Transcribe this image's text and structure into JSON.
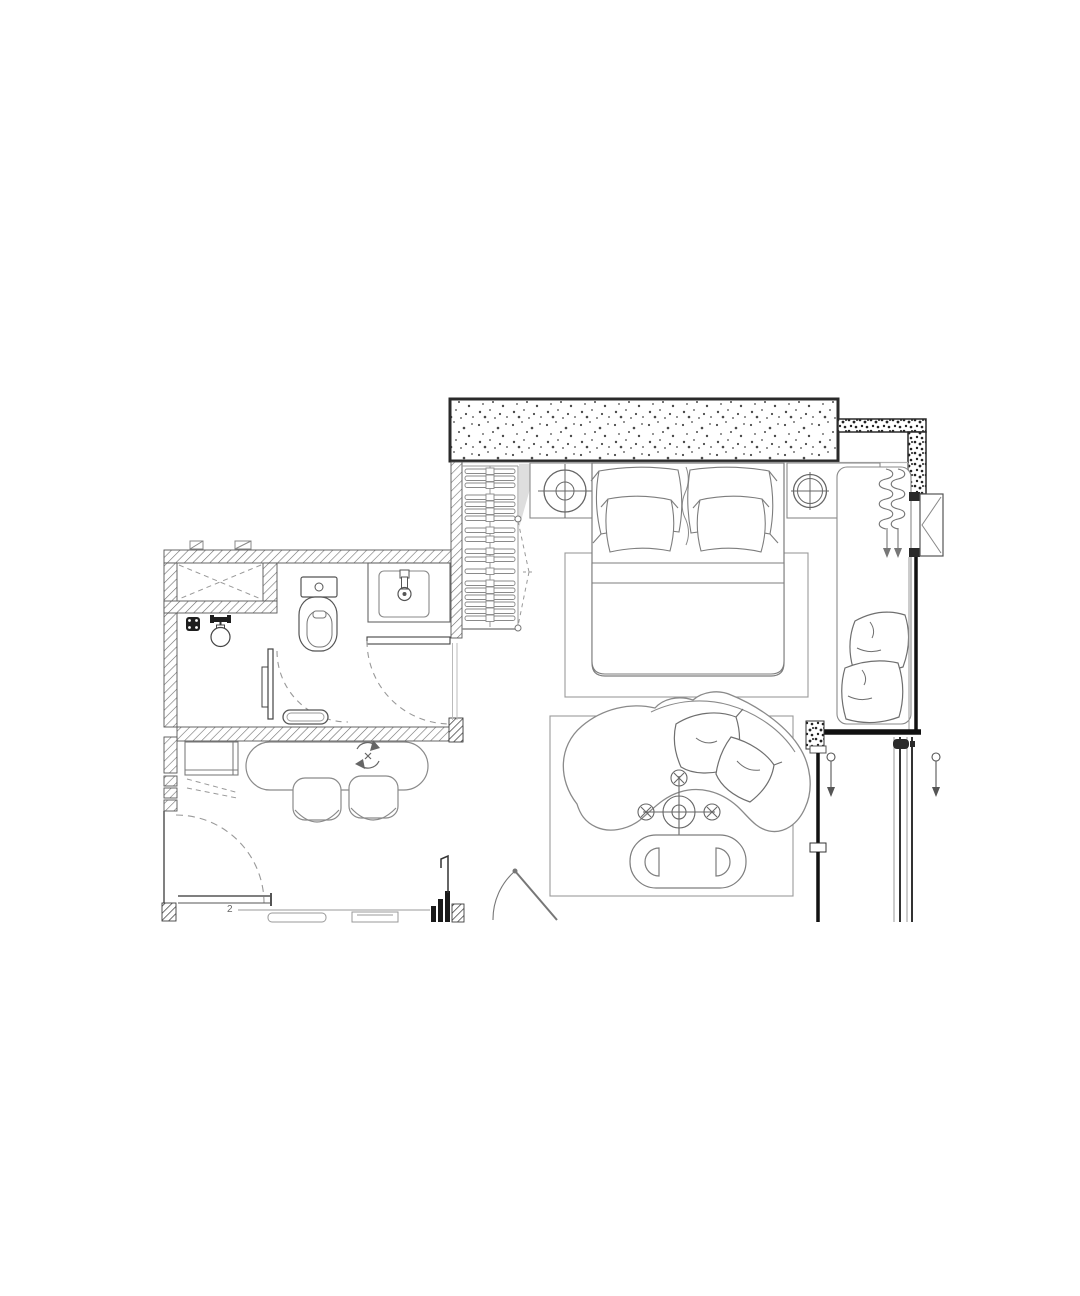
{
  "annotations": {
    "label_2": "2"
  },
  "plan": {
    "title": "Guest room floor plan (partial crop)",
    "style": "monochrome CAD line drawing on white background",
    "colors": {
      "background": "#ffffff",
      "concrete_wall_outline": "#2a2a2a",
      "masonry_hatch": "#666666",
      "furniture_line": "#8a8a8a",
      "glazing": "#111111"
    },
    "wall_types": [
      "stippled concrete shear wall",
      "diagonal-hatch masonry partition",
      "glazed window wall with sliding door"
    ],
    "rooms": [
      {
        "name": "bedroom",
        "items": [
          "double bed with 4 pillows",
          "bed area rug",
          "left nightstand with round table lamp",
          "right counter with round table lamp",
          "wardrobe with hanging rail and 18 hangers",
          "folding wardrobe door (dashed)",
          "window daybed with 2 cushions",
          "radiator coil with 2 down arrows"
        ]
      },
      {
        "name": "bathroom",
        "items": [
          "service shaft (dashed X)",
          "shower floor drain",
          "shower mixer head",
          "shower swing door",
          "shower bench",
          "toilet",
          "washbasin on counter",
          "main swing door to bedroom"
        ]
      },
      {
        "name": "entry-dining",
        "items": [
          "entry swing door (dashed arc)",
          "console shelf",
          "dashed fold-down indication",
          "oval dining table with rotation symbol",
          "2 dining chairs",
          "kitchen counter with appliances"
        ]
      },
      {
        "name": "living-area",
        "items": [
          "curved organic sofa with 2 cushions",
          "ceiling light / fan symbol",
          "oval coffee table with 2 D-shaped stools",
          "living area rug",
          "open door at an angle"
        ]
      },
      {
        "name": "balcony",
        "items": [
          "casement window symbol",
          "sliding glass door panel with direction arrows",
          "door handle"
        ]
      }
    ]
  }
}
